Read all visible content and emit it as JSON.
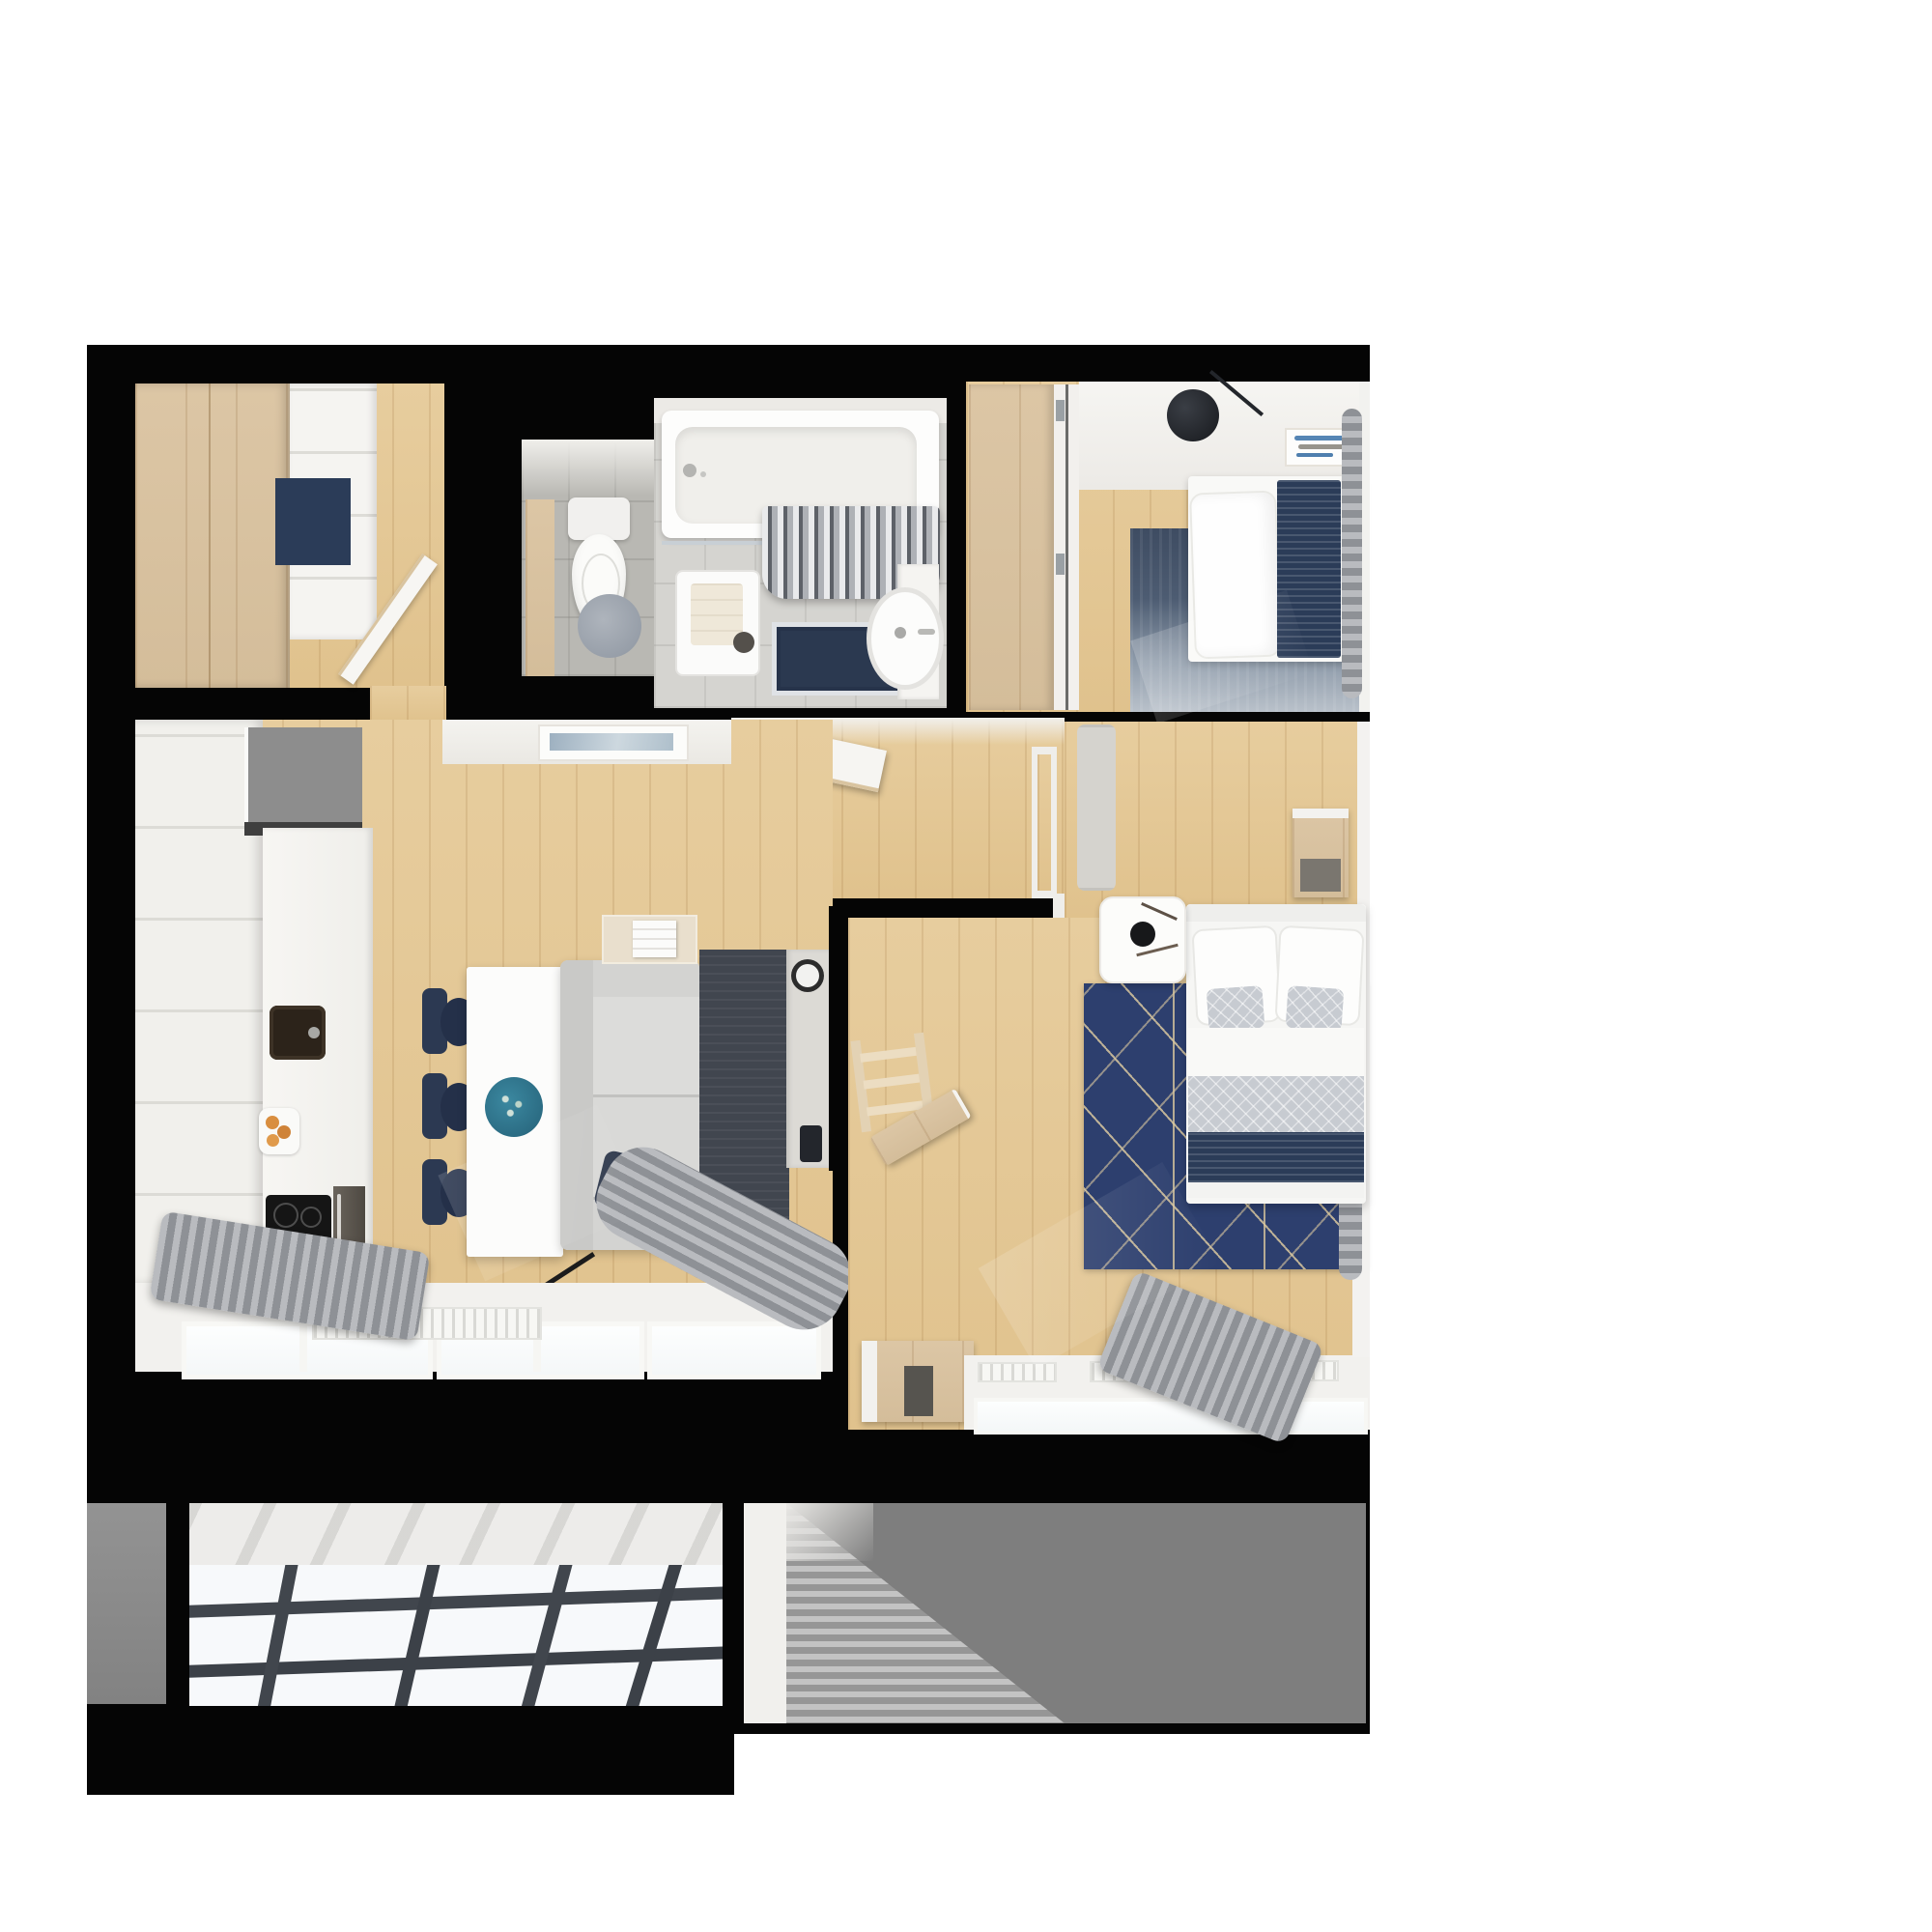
{
  "title": "Apartment 3D top-down floor plan rendering",
  "palette": {
    "canvas": "#ffffff",
    "wall": "#050505",
    "wood": "#e3c795",
    "cabinet_wood": "#d8c2a0",
    "white_furniture": "#f3f2ee",
    "gray_cabinet": "#8d8d8d",
    "navy": "#2b3c58",
    "rugblue": "#2d3f6e",
    "teal": "#2e7389",
    "curtain_gray": "#9fa1a6",
    "balcony_concrete": "#7e7e7e",
    "balcony_glass": "#f6f8fa"
  },
  "rooms": [
    {
      "name": "entry-hall",
      "furniture": [
        "wood-wardrobe",
        "white-cabinet",
        "navy-doormat",
        "open-door"
      ]
    },
    {
      "name": "wc",
      "furniture": [
        "toilet",
        "round-rug",
        "wood-shelf"
      ]
    },
    {
      "name": "bathroom",
      "furniture": [
        "bathtub",
        "shower-curtain",
        "washing-machine",
        "towel",
        "navy-bath-mat",
        "sink"
      ]
    },
    {
      "name": "bedroom-top-right",
      "furniture": [
        "wardrobe",
        "single-bed",
        "pillow",
        "navy-blanket",
        "gradient-rug",
        "wall-lamp",
        "art-frame",
        "window-curtain"
      ]
    },
    {
      "name": "corridor",
      "furniture": [
        "open-door-leaf",
        "door-frame"
      ]
    },
    {
      "name": "living-room-kitchen",
      "furniture": [
        "kitchen-cabinets",
        "gray-upper-cabinet",
        "sink",
        "cooktop",
        "oven",
        "fruit-plate",
        "dining-table",
        "teal-centerpiece",
        "dining-chair",
        "dining-chair",
        "dining-chair",
        "sofa",
        "navy-pillows",
        "floor-lamp",
        "wood-console",
        "magazine",
        "dark-rug",
        "tv-console",
        "speaker",
        "wall-art",
        "radiator",
        "windows",
        "gray-curtains"
      ]
    },
    {
      "name": "master-bedroom",
      "furniture": [
        "double-bed",
        "pillows",
        "quilt",
        "navy-runner",
        "nightstand",
        "black-vase",
        "geometric-blue-rug",
        "bench",
        "dresser",
        "ladder-shelf",
        "wood-console",
        "radiators",
        "windows",
        "gray-curtains"
      ]
    },
    {
      "name": "balcony-left",
      "furniture": [
        "glass-floor-grid",
        "concrete-ledge"
      ]
    },
    {
      "name": "balcony-right",
      "furniture": [
        "concrete-floor"
      ]
    }
  ]
}
